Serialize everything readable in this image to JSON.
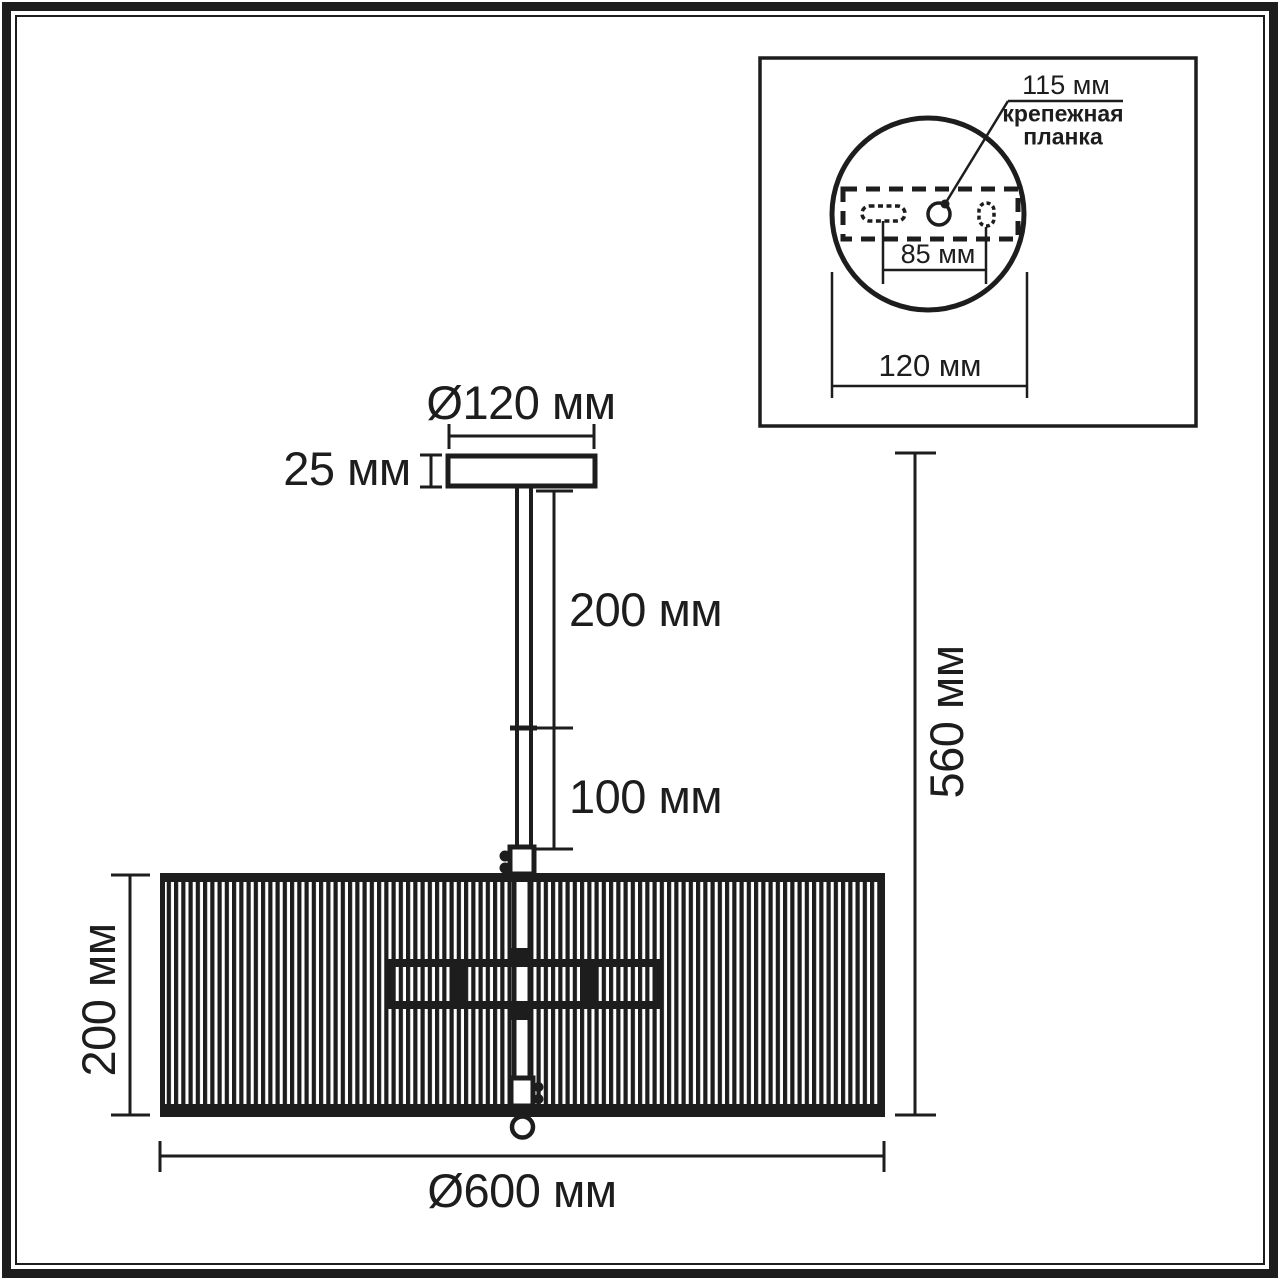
{
  "diagram": {
    "main_view": {
      "canopy_diameter_label": "Ø120 мм",
      "canopy_height_label": "25 мм",
      "rod_upper_label": "200 мм",
      "rod_lower_label": "100 мм",
      "shade_height_label": "200 мм",
      "overall_height_label": "560 мм",
      "shade_diameter_label": "Ø600 мм"
    },
    "inset_view": {
      "hole_offset_label": "115 мм",
      "bracket_label_line1": "крепежная",
      "bracket_label_line2": "планка",
      "hole_spacing_label": "85 мм",
      "plate_width_label": "120 мм"
    },
    "colors": {
      "ink": "#1d1d1d",
      "paper": "#ffffff"
    }
  }
}
